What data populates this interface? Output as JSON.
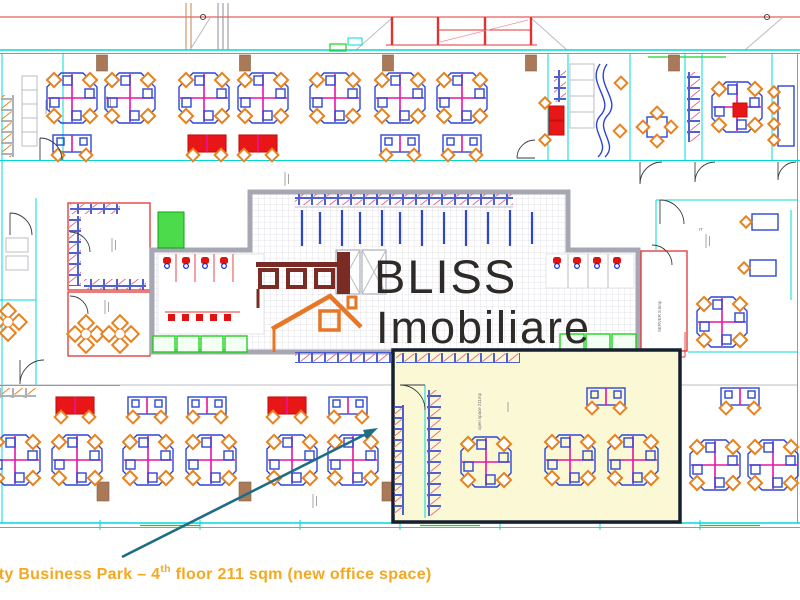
{
  "caption": {
    "prefix": "ity Business Park – 4",
    "superscript": "th",
    "suffix": " floor 211 sqm (new office space)"
  },
  "logo": {
    "line1": "BLISS",
    "line2": "Imobiliare"
  },
  "labels": {
    "highlighted_room": "open space 211mp",
    "server_room": "SERVER 8.5mp",
    "it_room": "IT"
  },
  "colors": {
    "wall_cyan": "#00d8d8",
    "wall_gray": "#a7a7b4",
    "line_red": "#e03434",
    "desk_blue": "#2d46d2",
    "desk_magenta": "#e613a4",
    "chair_orange": "#e8821f",
    "accent_green": "#1ed21e",
    "pillar_brown": "#a9795a",
    "highlight_fill": "#fbf8d6",
    "highlight_border": "#16202e",
    "logo_dark": "#2e2a28",
    "logo_orange": "#e87725",
    "logo_maroon": "#7a2b23",
    "caption_orange": "#f5a81f",
    "arrow_teal": "#1f6d85"
  }
}
